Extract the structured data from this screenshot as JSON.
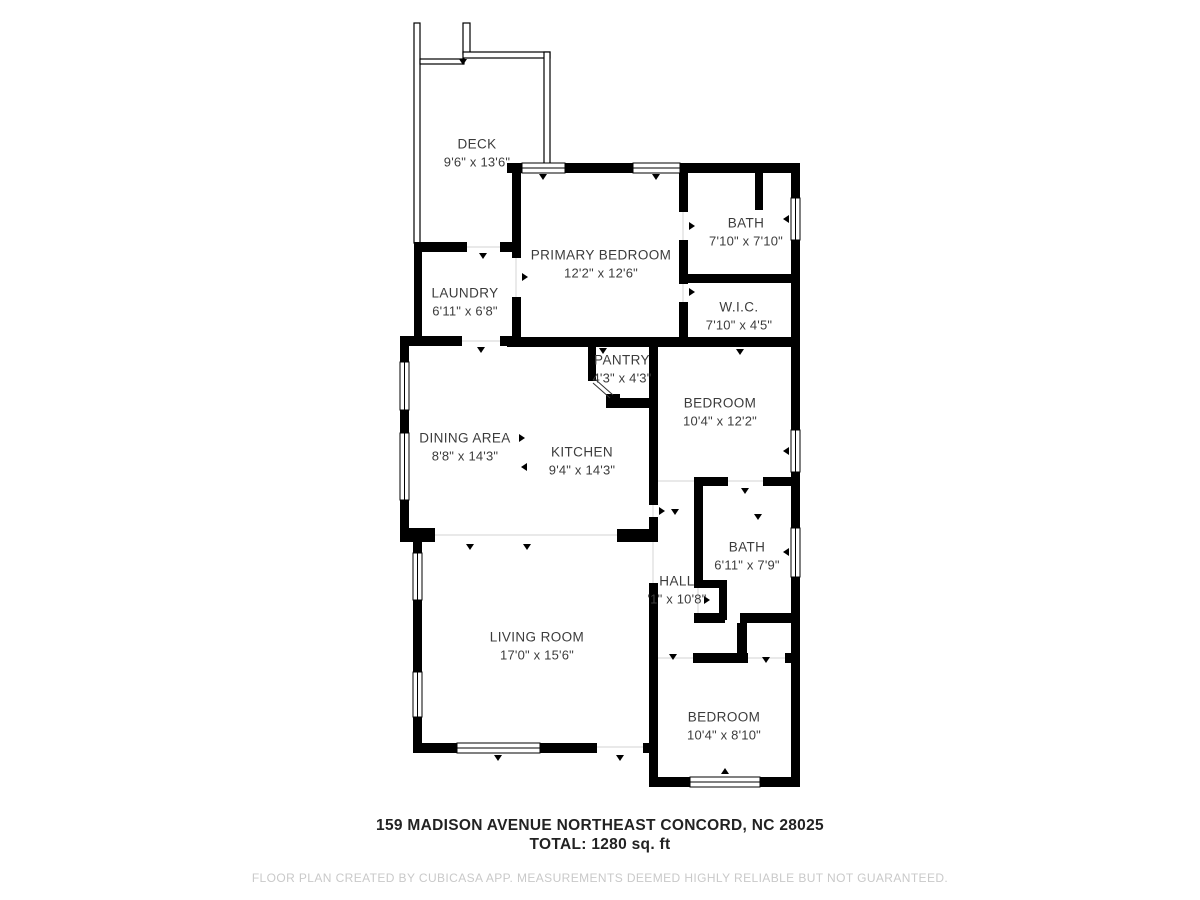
{
  "plan": {
    "wall_color": "#000000",
    "label_color": "#3c3c3c",
    "background": "#ffffff",
    "window_line_color": "#000000",
    "boundary_line_color": "#e2e2e2",
    "disclaimer_color": "#c9c9c9"
  },
  "rooms": [
    {
      "id": "deck",
      "name": "DECK",
      "dims": "9'6\" x 13'6\""
    },
    {
      "id": "primary-bedroom",
      "name": "PRIMARY BEDROOM",
      "dims": "12'2\" x 12'6\""
    },
    {
      "id": "bath-top",
      "name": "BATH",
      "dims": "7'10\" x 7'10\""
    },
    {
      "id": "laundry",
      "name": "LAUNDRY",
      "dims": "6'11\" x 6'8\""
    },
    {
      "id": "wic",
      "name": "W.I.C.",
      "dims": "7'10\" x 4'5\""
    },
    {
      "id": "pantry",
      "name": "PANTRY",
      "dims": "4'3\" x 4'3\""
    },
    {
      "id": "bedroom-middle",
      "name": "BEDROOM",
      "dims": "10'4\" x 12'2\""
    },
    {
      "id": "dining-area",
      "name": "DINING AREA",
      "dims": "8'8\" x 14'3\""
    },
    {
      "id": "kitchen",
      "name": "KITCHEN",
      "dims": "9'4\" x 14'3\""
    },
    {
      "id": "bath-lower",
      "name": "BATH",
      "dims": "6'11\" x 7'9\""
    },
    {
      "id": "hall",
      "name": "HALL",
      "dims": "'1\" x 10'8\""
    },
    {
      "id": "living-room",
      "name": "LIVING ROOM",
      "dims": "17'0\" x 15'6\""
    },
    {
      "id": "bedroom-bottom",
      "name": "BEDROOM",
      "dims": "10'4\" x 8'10\""
    }
  ],
  "footer": {
    "address": "159 MADISON AVENUE NORTHEAST CONCORD, NC 28025",
    "total": "TOTAL: 1280 sq. ft",
    "disclaimer": "FLOOR PLAN CREATED BY CUBICASA APP. MEASUREMENTS DEEMED HIGHLY RELIABLE BUT NOT GUARANTEED."
  }
}
